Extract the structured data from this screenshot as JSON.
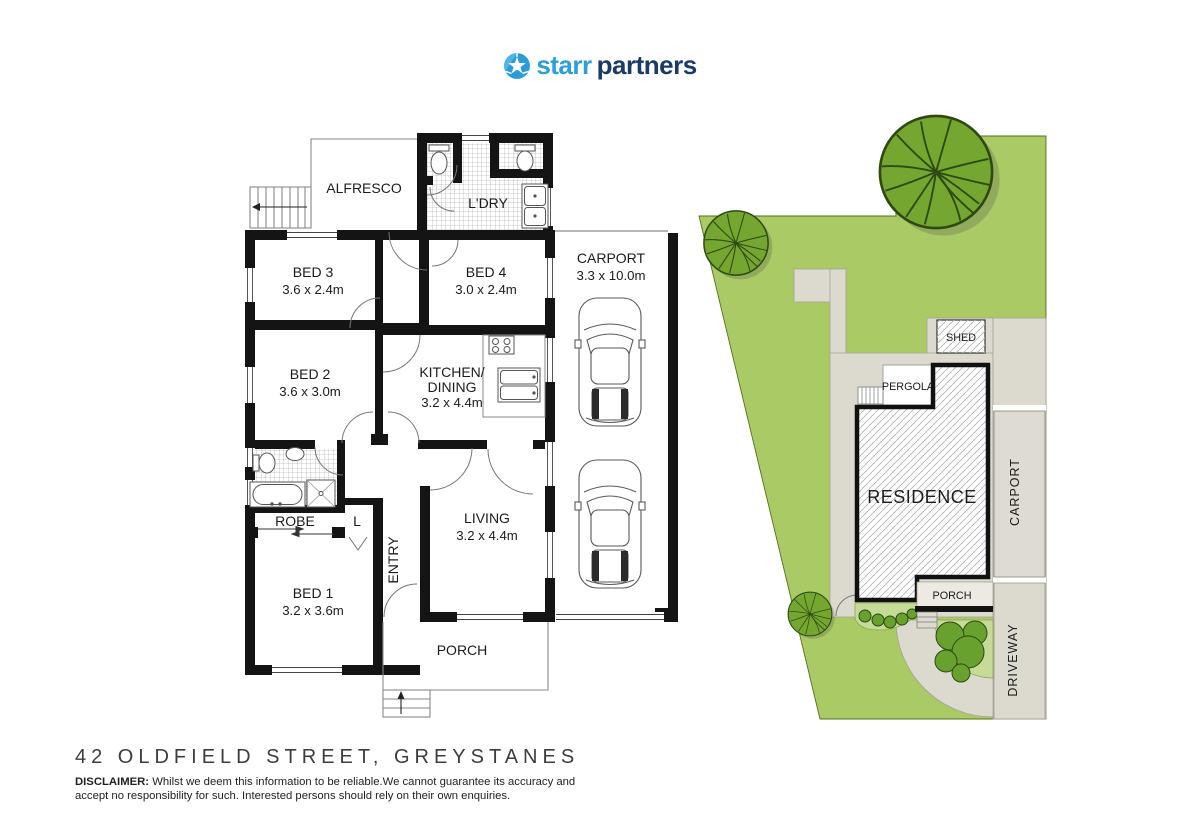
{
  "logo": {
    "brand_first": "starr",
    "brand_second": "partners",
    "color_first": "#2e9ed9",
    "color_second": "#1b3b66"
  },
  "fp": {
    "alfresco": "ALFRESCO",
    "ldry": "L'DRY",
    "bed3": "BED 3",
    "bed3_dims": "3.6 x 2.4m",
    "bed4": "BED 4",
    "bed4_dims": "3.0 x 2.4m",
    "carport": "CARPORT",
    "carport_dims": "3.3 x 10.0m",
    "bed2": "BED 2",
    "bed2_dims": "3.6 x 3.0m",
    "kitchen1": "KITCHEN/",
    "kitchen2": "DINING",
    "kitchen_dims": "3.2 x 4.4m",
    "robe": "ROBE",
    "linen": "L",
    "bed1": "BED 1",
    "bed1_dims": "3.2 x 3.6m",
    "entry": "ENTRY",
    "living": "LIVING",
    "living_dims": "3.2 x 4.4m",
    "porch": "PORCH"
  },
  "sp": {
    "shed": "SHED",
    "pergola": "PERGOLA",
    "residence": "RESIDENCE",
    "carport": "CARPORT",
    "porch": "PORCH",
    "driveway": "DRIVEWAY",
    "grass_color": "#a9ca64",
    "tree_color": "#74a630",
    "paving_color": "#dcdacf",
    "garden_color": "#c6db97",
    "bush_color": "#69a12e"
  },
  "footer": {
    "address": "42 OLDFIELD STREET, GREYSTANES",
    "disclaimer_label": "DISCLAIMER:",
    "disclaimer_line1": "Whilst we deem this information to be reliable.We cannot guarantee its accuracy and",
    "disclaimer_line2": "accept no responsibility for such. Interested persons should rely on their own enquiries."
  }
}
